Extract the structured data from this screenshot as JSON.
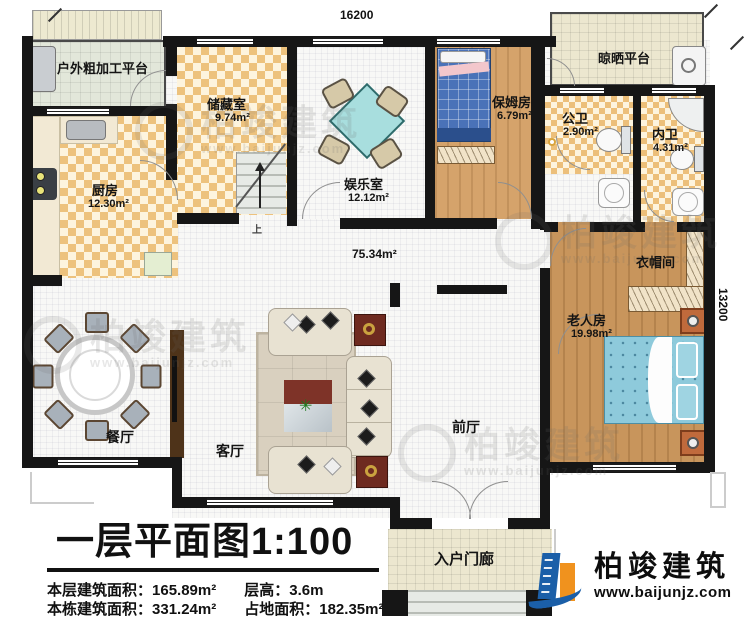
{
  "dimensions": {
    "top": "16200",
    "right": "13200"
  },
  "rooms": {
    "outdoor_platform": {
      "label": "户外粗加工平台"
    },
    "storage": {
      "label": "储藏室",
      "area": "9.74m²"
    },
    "game_room": {
      "label": "娱乐室",
      "area": "12.12m²"
    },
    "nanny_room": {
      "label": "保姆房",
      "area": "6.79m²"
    },
    "drying_platform": {
      "label": "晾晒平台"
    },
    "public_bath": {
      "label": "公卫",
      "area": "2.90m²"
    },
    "private_bath": {
      "label": "内卫",
      "area": "4.31m²"
    },
    "kitchen": {
      "label": "厨房",
      "area": "12.30m²"
    },
    "cloakroom": {
      "label": "衣帽间"
    },
    "elder_room": {
      "label": "老人房",
      "area": "19.98m²"
    },
    "hall": {
      "area": "75.34m²"
    },
    "dining": {
      "label": "餐厅"
    },
    "living": {
      "label": "客厅"
    },
    "front_hall": {
      "label": "前厅"
    },
    "porch": {
      "label": "入户门廊"
    },
    "stairs": {
      "label": "上"
    }
  },
  "title": {
    "text": "一层平面图",
    "scale": "1:100"
  },
  "stats": {
    "floor_area_label": "本层建筑面积：",
    "floor_area_value": "165.89m²",
    "height_label": "层高：",
    "height_value": "3.6m",
    "total_area_label": "本栋建筑面积：",
    "total_area_value": "331.24m²",
    "footprint_label": "占地面积：",
    "footprint_value": "182.35m²"
  },
  "brand": {
    "name": "柏竣建筑",
    "url": "www.baijunjz.com"
  },
  "watermark": {
    "name": "柏竣建筑",
    "url": "www.baijunjz.com"
  },
  "colors": {
    "wall": "#161616",
    "checker": "#edc27d",
    "wood": "#c8955c",
    "bed_blue": "#8ecadb",
    "accent_blue": "#1b5fa8",
    "accent_orange": "#f0921e"
  }
}
